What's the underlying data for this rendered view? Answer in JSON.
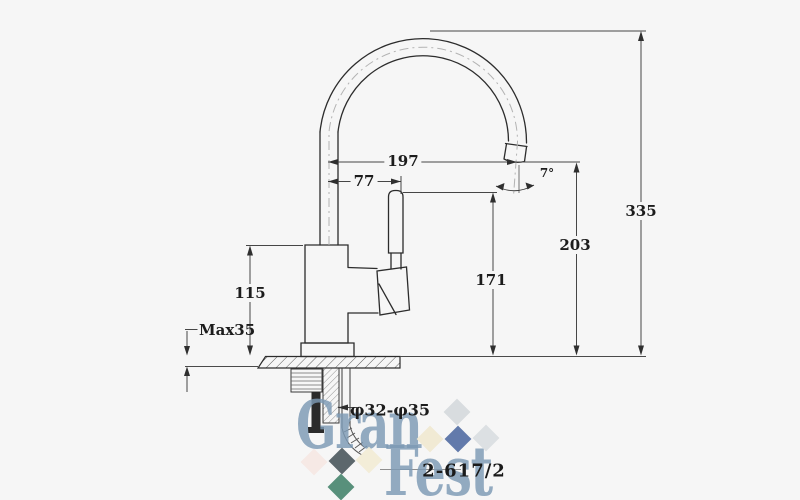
{
  "drawing": {
    "dims": {
      "spout_reach": "197",
      "handle_offset": "77",
      "outlet_angle": "7°",
      "height_total": "335",
      "height_outlet": "203",
      "height_handle": "171",
      "height_body": "115",
      "counter_max": "Max35",
      "hole_dia": "φ32-φ35"
    },
    "model": "2-617/2"
  },
  "watermark": {
    "line1": "Gran",
    "line2": "Fest",
    "color": "#7d9ab5",
    "diamonds": [
      {
        "x": 457,
        "y": 412,
        "color": "#d6dadd"
      },
      {
        "x": 430,
        "y": 439,
        "color": "#f0e9d2"
      },
      {
        "x": 458,
        "y": 439,
        "color": "#5a73a6"
      },
      {
        "x": 486,
        "y": 438,
        "color": "#dadee1"
      },
      {
        "x": 314,
        "y": 462,
        "color": "#f6e8e4"
      },
      {
        "x": 342,
        "y": 461,
        "color": "#535f64"
      },
      {
        "x": 369,
        "y": 460,
        "color": "#f2ecd6"
      },
      {
        "x": 341,
        "y": 487,
        "color": "#4f8a74"
      }
    ]
  }
}
